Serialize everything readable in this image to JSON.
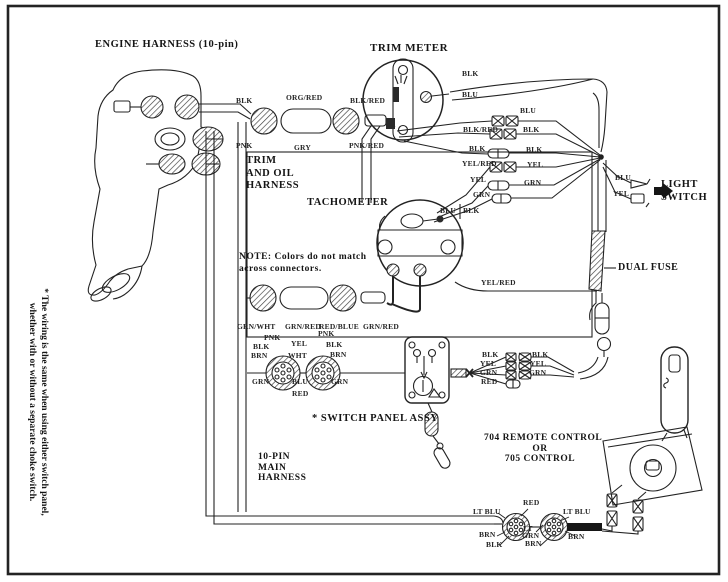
{
  "page": {
    "ink": "#1f1f1f",
    "paper": "#ffffff"
  },
  "titles": {
    "engine_harness": "ENGINE HARNESS (10-pin)",
    "trim_meter": "TRIM METER",
    "tachometer": "TACHOMETER",
    "trim_oil_l1": "TRIM",
    "trim_oil_l2": "AND OIL",
    "trim_oil_l3": "HARNESS",
    "light_l1": "LIGHT",
    "light_l2": "SWITCH",
    "dual_fuse": "DUAL FUSE",
    "switch_panel_assy": "* SWITCH PANEL ASSY",
    "remote_l1": "704 REMOTE CONTROL",
    "remote_l2": "OR",
    "remote_l3": "705 CONTROL",
    "main_l1": "10-PIN",
    "main_l2": "MAIN",
    "main_l3": "HARNESS"
  },
  "note": {
    "l1": "NOTE: Colors do not match",
    "l2": "across connectors."
  },
  "footnote": {
    "l1": "* The wiring is the same when using either switch panel,",
    "l2": "whether with or without a separate choke switch."
  },
  "wire_colors": {
    "blk": "BLK",
    "blu": "BLU",
    "pnk": "PNK",
    "gry": "GRY",
    "grn": "GRN",
    "yel": "YEL",
    "red": "RED",
    "brn": "BRN",
    "wht": "WHT",
    "org_red": "ORG/RED",
    "blk_red": "BLK/RED",
    "pnk_red": "PNK/RED",
    "yel_red": "YEL/RED",
    "grn_wht": "GRN/WHT",
    "grn_red": "GRN/RED",
    "red_blue": "RED/BLUE",
    "lt_blu": "LT BLU",
    "lt": "LT"
  }
}
